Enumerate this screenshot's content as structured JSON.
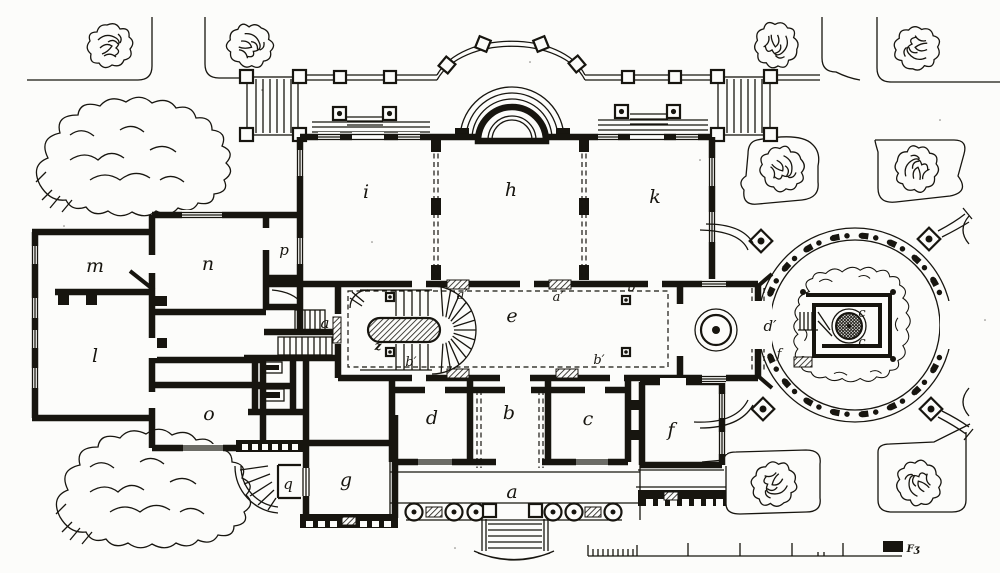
{
  "palette": {
    "ink": "#17150f",
    "paper": "#fcfcfa"
  },
  "labels": {
    "rooms": [
      {
        "id": "i",
        "text": "i"
      },
      {
        "id": "h",
        "text": "h"
      },
      {
        "id": "k",
        "text": "k"
      },
      {
        "id": "m",
        "text": "m"
      },
      {
        "id": "n",
        "text": "n"
      },
      {
        "id": "p",
        "text": "p"
      },
      {
        "id": "l",
        "text": "l"
      },
      {
        "id": "o",
        "text": "o"
      },
      {
        "id": "q",
        "text": "q"
      },
      {
        "id": "g",
        "text": "g"
      },
      {
        "id": "d",
        "text": "d"
      },
      {
        "id": "b",
        "text": "b"
      },
      {
        "id": "c",
        "text": "c"
      },
      {
        "id": "f",
        "text": "f"
      },
      {
        "id": "e",
        "text": "e"
      },
      {
        "id": "a-terrace",
        "text": "a"
      },
      {
        "id": "a-door",
        "text": "a"
      },
      {
        "id": "z-stair",
        "text": "z"
      }
    ],
    "marks": [
      {
        "id": "a-prime-1",
        "text": "a′"
      },
      {
        "id": "a-prime-2",
        "text": "a′"
      },
      {
        "id": "b-prime-1",
        "text": "b′"
      },
      {
        "id": "b-prime-2",
        "text": "b′"
      },
      {
        "id": "b-prime-3",
        "text": "b′"
      },
      {
        "id": "d-prime",
        "text": "d′"
      },
      {
        "id": "f-grotto",
        "text": "f"
      },
      {
        "id": "c-grotto-1",
        "text": "c"
      },
      {
        "id": "c-grotto-2",
        "text": "c"
      }
    ],
    "scale_label": "Fʒ"
  }
}
